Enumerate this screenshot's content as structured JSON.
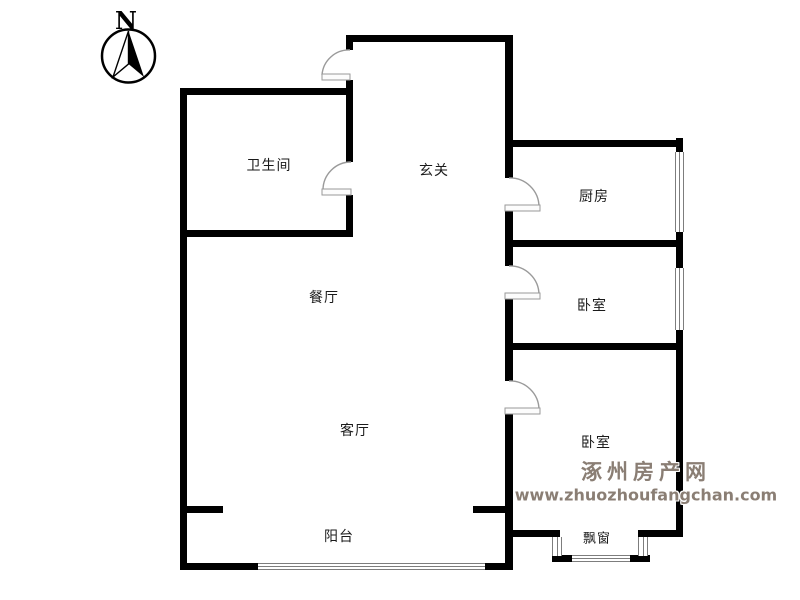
{
  "compass": {
    "label": "N"
  },
  "rooms": {
    "bathroom": "卫生间",
    "hallway": "玄关",
    "kitchen": "厨房",
    "bedroom_top": "卧室",
    "dining": "餐厅",
    "bedroom_bottom": "卧室",
    "living": "客厅",
    "balcony": "阳台",
    "bay_window": "飘窗"
  },
  "watermark": {
    "site_name": "涿州房产网",
    "site_url": "www.zhuozhoufangchan.com",
    "color": "#8a7e74"
  },
  "colors": {
    "wall": "#000000",
    "door_line": "#9a9a9a",
    "window_line": "#7d7d7d",
    "label_text": "#1a1a1a",
    "background": "#ffffff"
  }
}
